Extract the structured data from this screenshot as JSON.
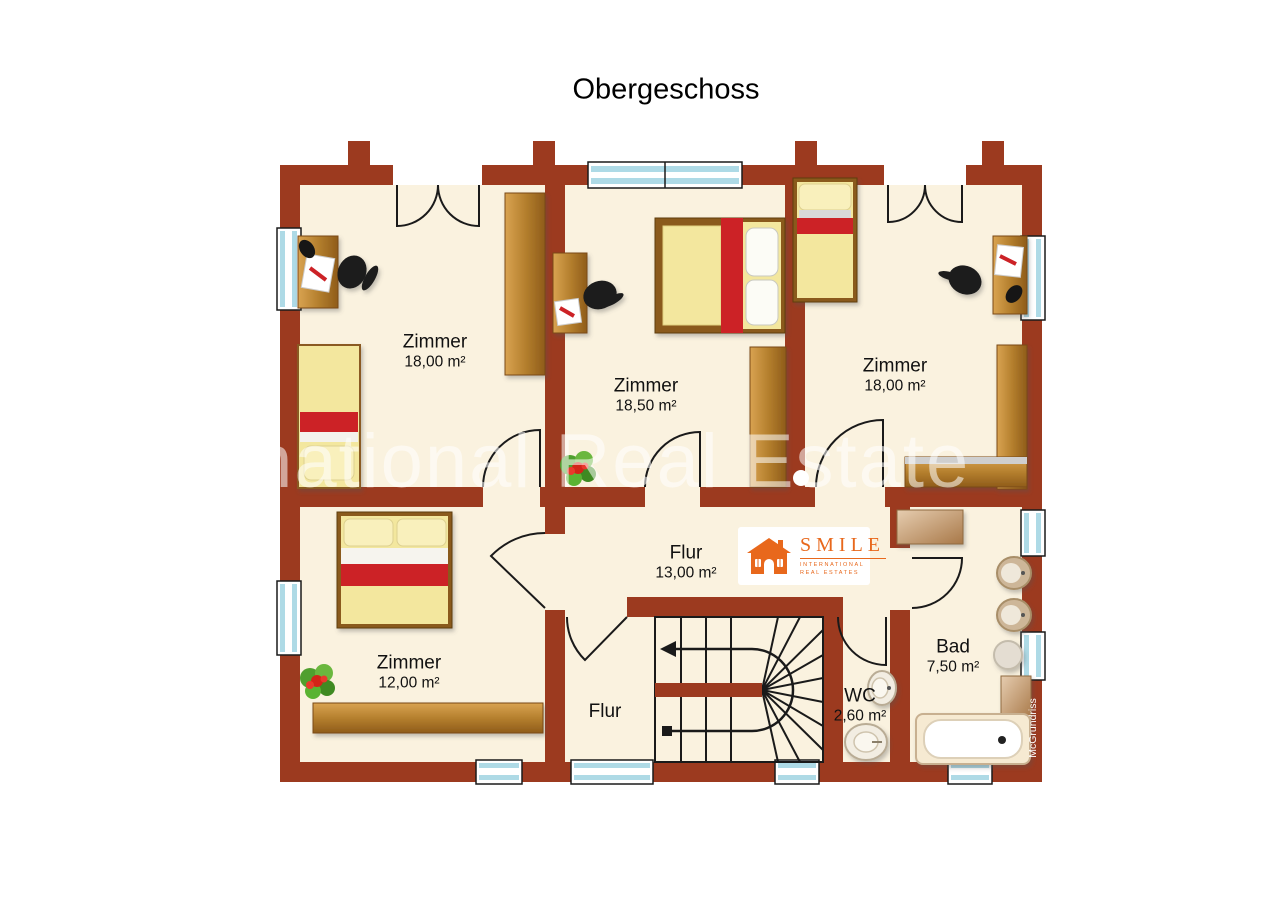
{
  "title": "Obergeschoss",
  "watermark": "International Real Estate",
  "credit": "McGrundriss",
  "logo": {
    "name": "SMILE",
    "line1": "INTERNATIONAL",
    "line2": "REAL ESTATES"
  },
  "rooms": [
    {
      "id": "room-top-left",
      "label": "Zimmer",
      "area": "18,00 m²"
    },
    {
      "id": "room-top-middle",
      "label": "Zimmer",
      "area": "18,50 m²"
    },
    {
      "id": "room-top-right",
      "label": "Zimmer",
      "area": "18,00 m²"
    },
    {
      "id": "room-bottom-left",
      "label": "Zimmer",
      "area": "12,00 m²"
    },
    {
      "id": "hall-upper",
      "label": "Flur",
      "area": "13,00 m²"
    },
    {
      "id": "hall-lower",
      "label": "Flur",
      "area": ""
    },
    {
      "id": "wc",
      "label": "WC",
      "area": "2,60 m²"
    },
    {
      "id": "bath",
      "label": "Bad",
      "area": "7,50 m²"
    }
  ],
  "colors": {
    "wall": "#9c3a1f",
    "floor": "#faf2df",
    "accent_red": "#cc2127",
    "bed_yellow": "#f3e79e",
    "window_blue": "#aedae6",
    "wood_light": "#cf9a45",
    "wood_dark": "#9a681f",
    "logo_orange": "#e8681c"
  }
}
